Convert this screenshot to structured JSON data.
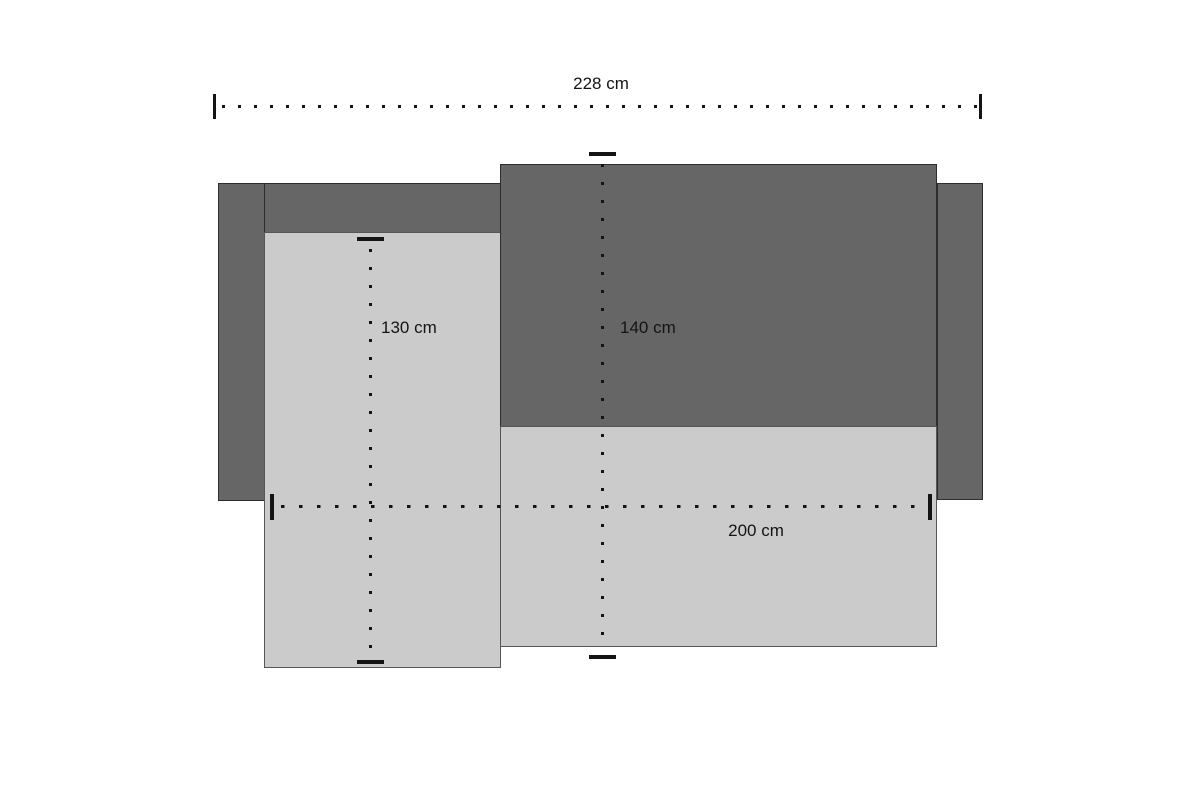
{
  "diagram": {
    "dimensions": {
      "total_width": {
        "label": "228 cm",
        "orientation": "horizontal"
      },
      "chaise_length": {
        "label": "130 cm",
        "orientation": "vertical"
      },
      "depth": {
        "label": "140 cm",
        "orientation": "vertical"
      },
      "seat_width": {
        "label": "200 cm",
        "orientation": "horizontal"
      }
    },
    "colors": {
      "frame_dark": "#666666",
      "cushion_light": "#cbcbcb",
      "dimension_lines": "#141414",
      "background": "#ffffff"
    }
  }
}
